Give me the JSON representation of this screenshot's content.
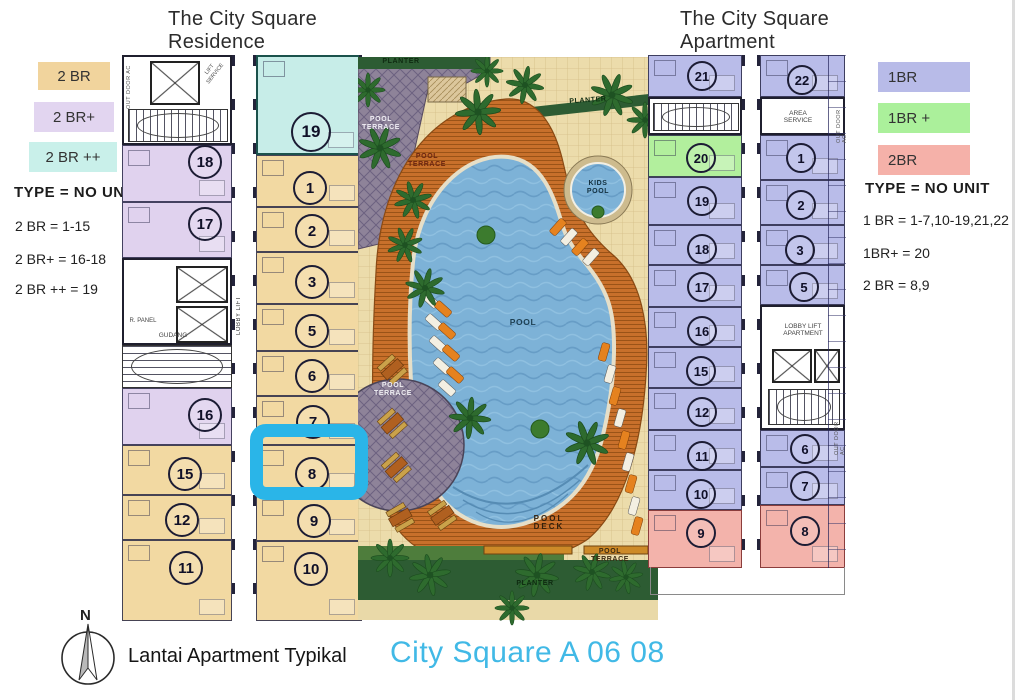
{
  "residence": {
    "title_lines": [
      "The City Square",
      "Residence"
    ],
    "legend": [
      {
        "label": "2 BR",
        "color": "#f1d49d"
      },
      {
        "label": "2 BR+",
        "color": "#e2d5f0"
      },
      {
        "label": "2 BR ++",
        "color": "#c9f0ea"
      }
    ],
    "type_heading": "TYPE = NO UNIT",
    "type_lines": [
      "2 BR   = 1-15",
      "2 BR+ = 16-18",
      "2 BR ++  = 19"
    ],
    "units_left_col": [
      "18",
      "17",
      "16",
      "15",
      "12",
      "11"
    ],
    "units_right_col": [
      "19",
      "1",
      "2",
      "3",
      "5",
      "6",
      "7",
      "8",
      "9",
      "10"
    ],
    "labels": {
      "out_door_ac": "OUT DOOR AC",
      "lift_service": "LIFT SERVICE",
      "r_panel": "R. PANEL",
      "lobby_lift": "LOBBY LIFT",
      "gudang": "GUDANG"
    }
  },
  "apartment": {
    "title_lines": [
      "The City Square",
      "Apartment"
    ],
    "legend": [
      {
        "label": "1BR",
        "color": "#b8bbe8"
      },
      {
        "label": "1BR  +",
        "color": "#abf09b"
      },
      {
        "label": "2BR",
        "color": "#f5b1a9"
      }
    ],
    "type_heading": "TYPE = NO UNIT",
    "type_lines": [
      "1 BR = 1-7,10-19,21,22",
      "1BR+ = 20",
      "2 BR  = 8,9"
    ],
    "units_left_col": [
      "21",
      "20",
      "19",
      "18",
      "17",
      "16",
      "15",
      "12",
      "11",
      "10",
      "9"
    ],
    "units_right_col": [
      "22",
      "1",
      "2",
      "3",
      "5",
      "6",
      "7",
      "8"
    ],
    "labels": {
      "area_service": "AREA SERVICE",
      "lobby_lift_apartment": "LOBBY LIFT APARTMENT",
      "out_door_ac": "OUT DOOR AC"
    }
  },
  "courtyard": {
    "planter": "PLANTER",
    "pool_terrace": "POOL TERRACE",
    "kids_pool": "KIDS POOL",
    "pool": "POOL",
    "pool_deck": "POOL DECK"
  },
  "footer": {
    "north": "N",
    "caption": "Lantai Apartment Typikal",
    "plan_title": "City Square A 06 08",
    "plan_title_color": "#41b9e6"
  },
  "highlight": {
    "building": "residence",
    "unit": "8",
    "color": "#2ab5e8"
  }
}
